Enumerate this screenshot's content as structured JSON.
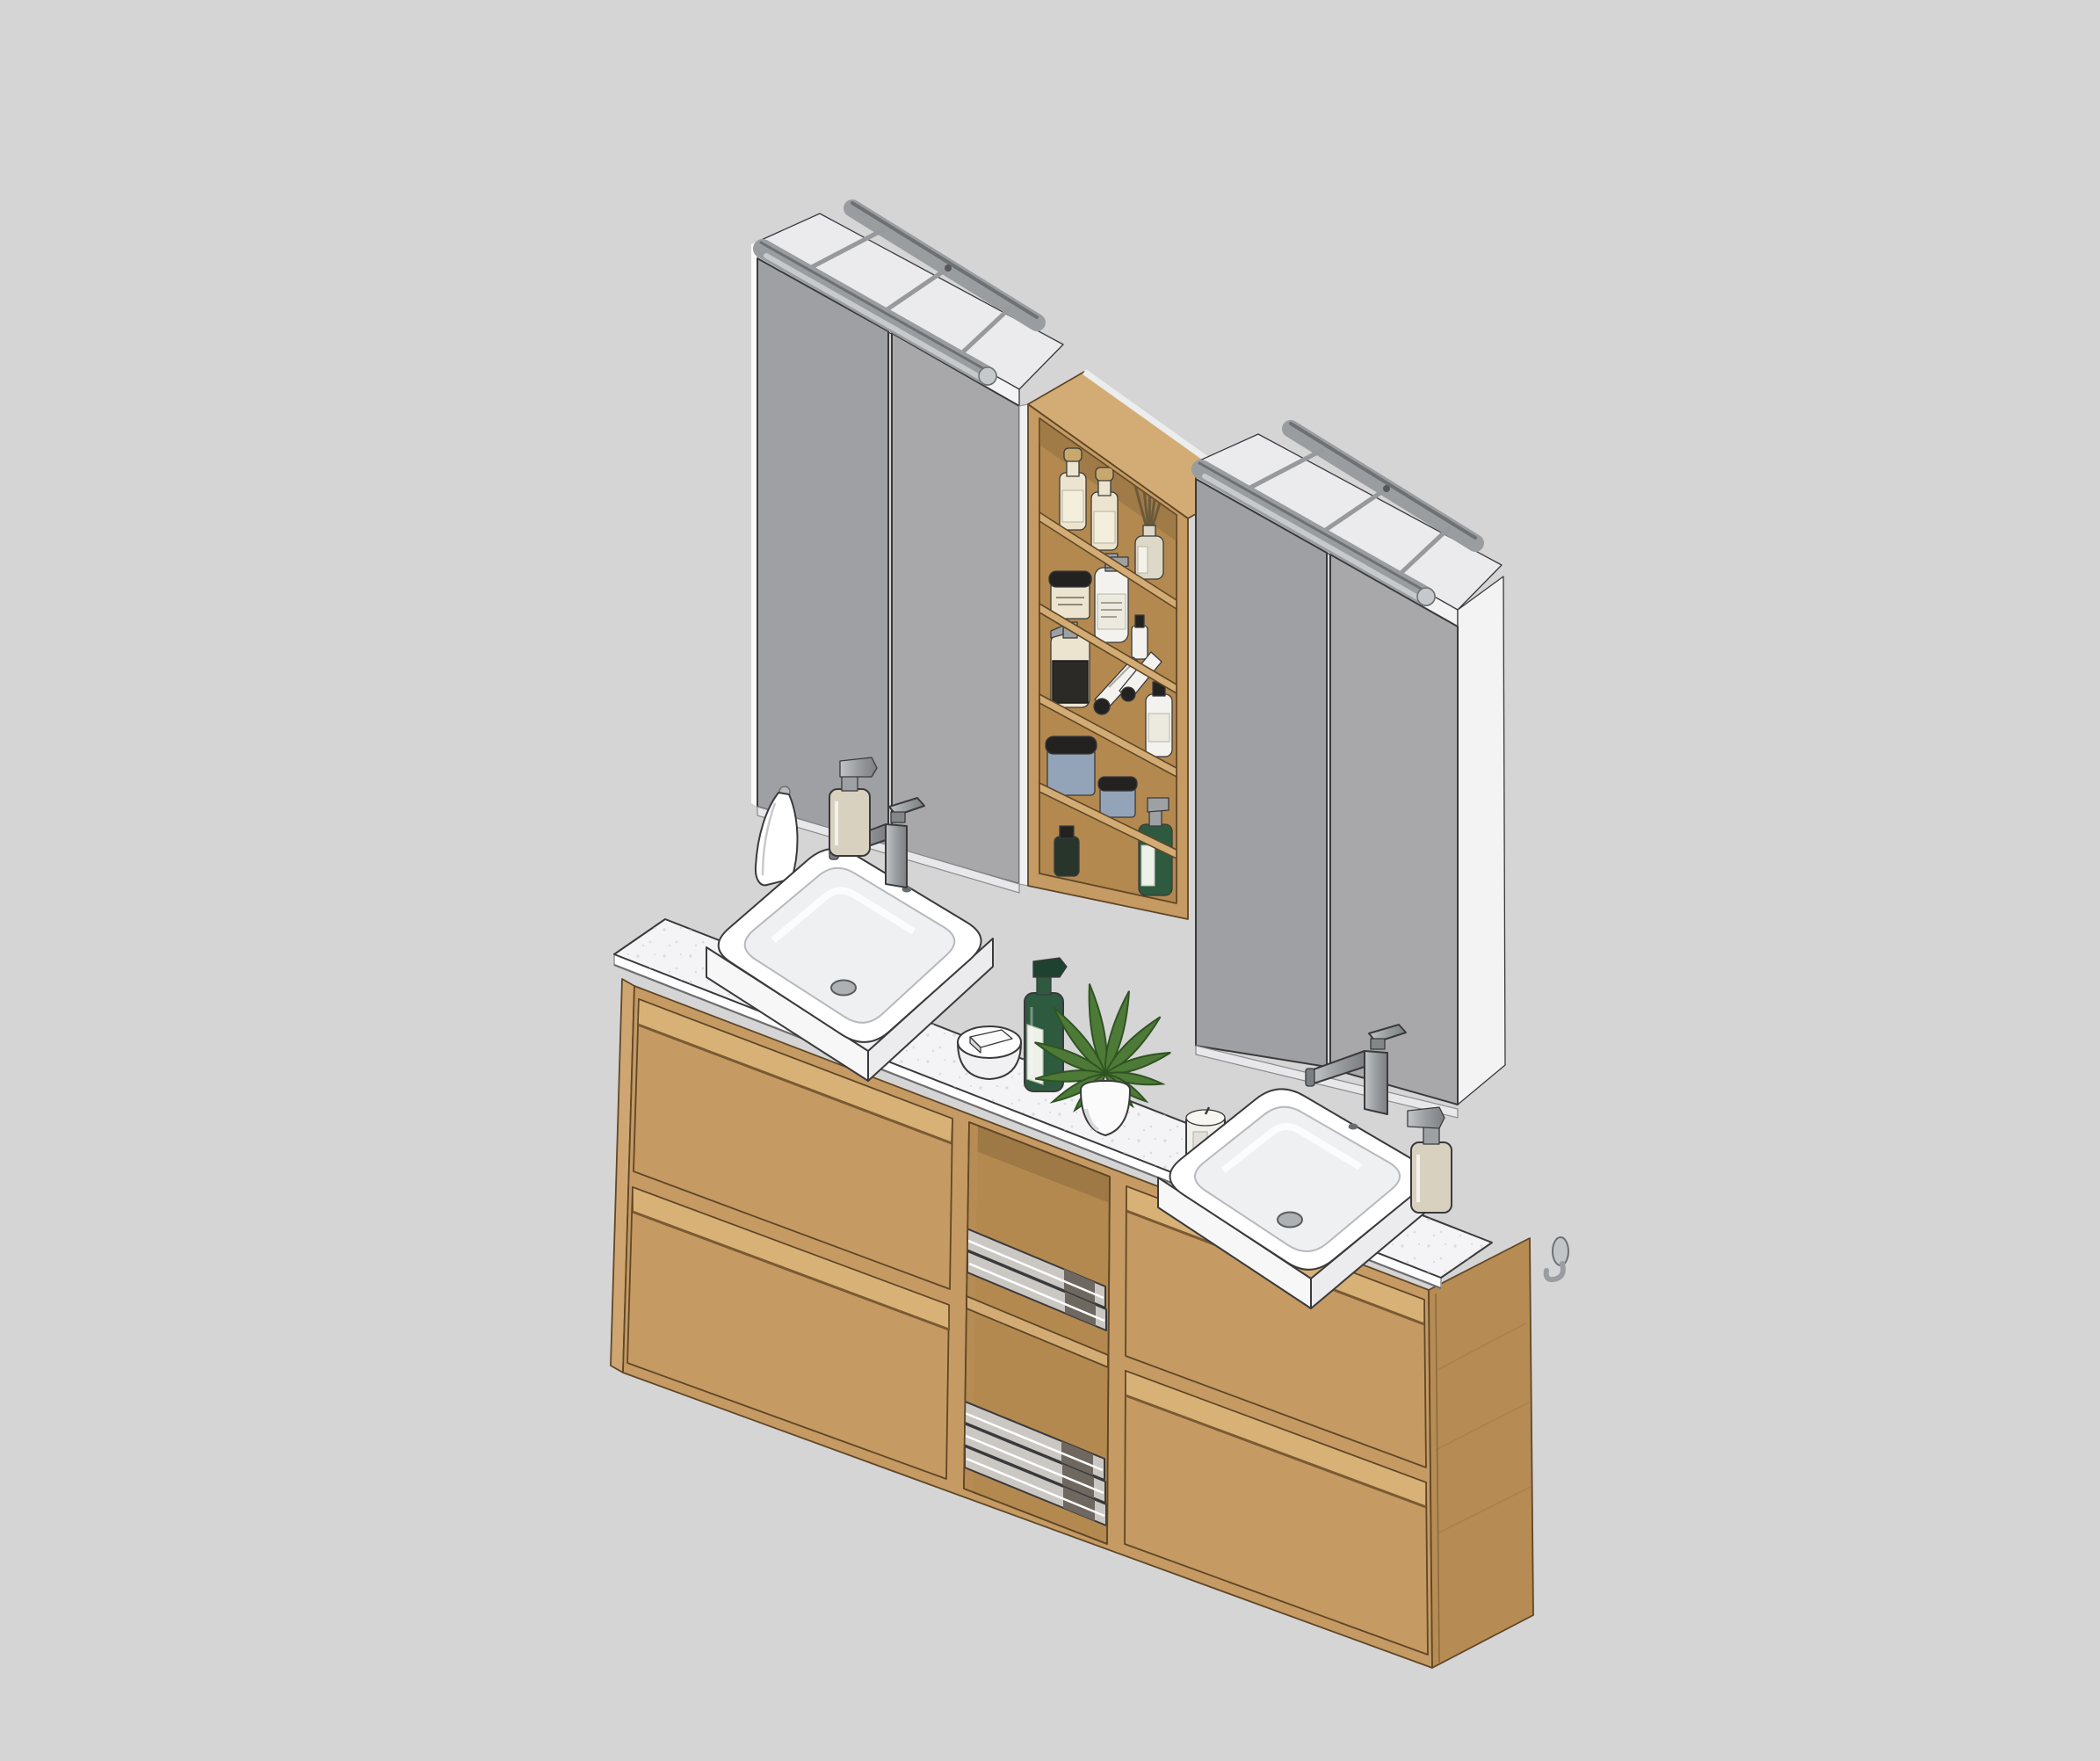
{
  "view": {
    "type": "3d-isometric-render",
    "description": "SketchUp-style rendering of a wall-hung double bathroom vanity with oak drawers, white stone countertop, two semi-recessed basins, central open shelf unit with toiletries, two mirror cabinets with over-mirror light rails, towel niche and accessories",
    "background": "#d5d5d6"
  },
  "palette": {
    "background": "#d5d5d6",
    "mirror": "#a8a8aa",
    "mirror2": "#9fa0a3",
    "cabinetWhite": "#f3f3f4",
    "topWhite": "#ebebed",
    "lightBar": "#9a9da0",
    "lightBarEdge": "#6e7174",
    "lightBarGlow": "#c7cacc",
    "stemGray": "#97999c",
    "woodFront": "#c59a63",
    "woodSide": "#b68c54",
    "woodTop": "#d3ac75",
    "woodInner": "#b3894f",
    "woodLine": "#5f4727",
    "counterTop": "#f4f4f6",
    "counterSpeck": "#c9c9cd",
    "outline": "#3a3a3c",
    "sinkWhite": "#ffffff",
    "basinShade": "#eef0f2",
    "sinkFace": "#f7f7f8",
    "sinkFaceShade": "#ececef",
    "beige": "#d9d1c0",
    "pumpGray": "#9ea1a4",
    "towelGray": "#cbc8c4",
    "towelStripe": "#6f6860",
    "plantGreen": "#4e7a37",
    "plantDark": "#2f5423",
    "greenBottle": "#2e5a40",
    "labelWhite": "#eef0ea",
    "candleWhite": "#f0efe9",
    "creamBottle": "#ece4cf",
    "cork": "#c8a86b",
    "jarBlack": "#232220",
    "jarBlue": "#93a3b8",
    "tubeWhite": "#f3f2ee",
    "glass": "#ddd8c8",
    "stick": "#6b5a3a"
  },
  "scene": {
    "mirror_cabinets": [
      {
        "side": "left",
        "doors": 2,
        "light_rail": true
      },
      {
        "side": "right",
        "doors": 2,
        "light_rail": true
      }
    ],
    "shelf_unit": {
      "material": "oak",
      "shelf_boards": 4,
      "compartments": 5,
      "items": [
        [
          "amber apothecary bottle",
          "amber apothecary bottle",
          "reed diffuser"
        ],
        [
          "cream jar with black lid",
          "white pump bottle",
          "small bottle"
        ],
        [
          "pump bottle with dark label",
          "two squeeze tubes",
          "white bottle"
        ],
        [
          "large blue jar with black lid",
          "small blue jar with black lid"
        ],
        [
          "small dark bottle",
          "green bottle with pump"
        ]
      ]
    },
    "vanity": {
      "countertop": "white stone with speckles",
      "sections": [
        "two drawers",
        "open towel niche",
        "two drawers"
      ],
      "drawers": 4,
      "towel_shelves": 2,
      "towels": 5,
      "sinks": 2
    },
    "counter_items": [
      "white towel on wall hook",
      "soap dispenser",
      "basin mixer faucet",
      "soap dish with soap bar",
      "green soap bottle",
      "potted plant",
      "scented candle",
      "basin mixer faucet",
      "soap dispenser",
      "wall hook"
    ]
  }
}
